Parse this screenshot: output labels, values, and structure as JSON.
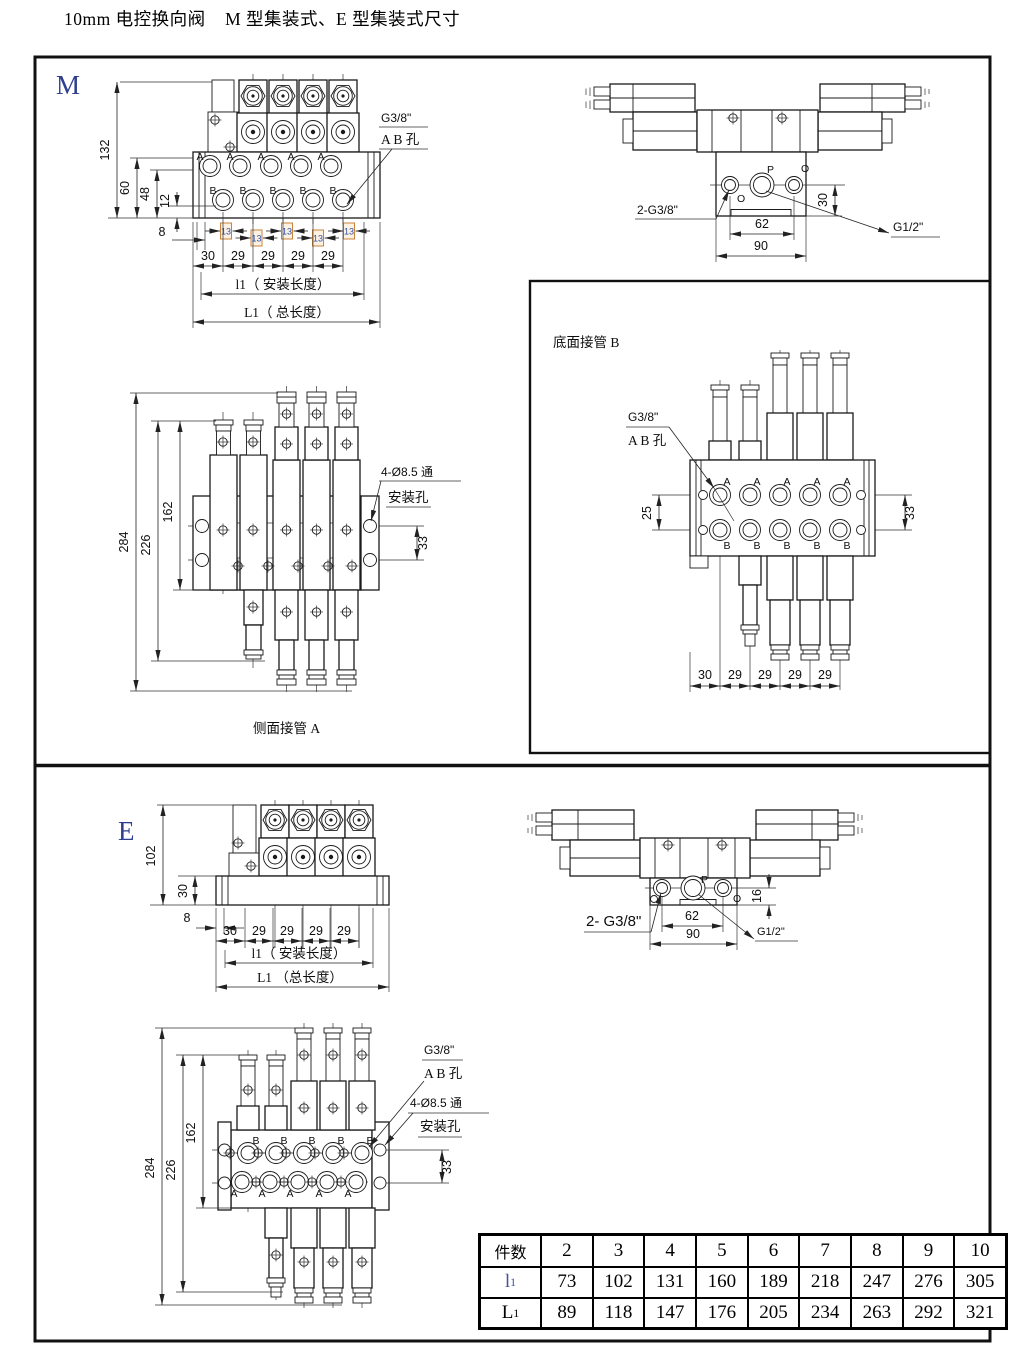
{
  "page": {
    "title": "10mm 电控换向阀    M 型集装式、E 型集装式尺寸"
  },
  "m": {
    "label": "M",
    "front": {
      "t132": "132",
      "t60": "60",
      "t48": "48",
      "t12": "12",
      "t8": "8",
      "pitch": [
        "30",
        "29",
        "29",
        "29",
        "29"
      ],
      "t13": [
        "13",
        "13",
        "13",
        "13",
        "13"
      ],
      "ports_a": [
        "A",
        "A",
        "A",
        "A",
        "A"
      ],
      "ports_b": [
        "B",
        "B",
        "B",
        "B",
        "B"
      ],
      "note1": "G3/8\"",
      "note2": "A B 孔",
      "lmount": "l1（ 安装长度）",
      "ltotal": "L1（ 总长度）"
    },
    "side": {
      "note": "2-G3/8\"",
      "g12": "G1/2\"",
      "t30": "30",
      "t62": "62",
      "t90": "90",
      "pp": "P",
      "po1": "O",
      "po2": "O"
    },
    "top": {
      "t284": "284",
      "t226": "226",
      "t162": "162",
      "t33": "33",
      "note1": "4-Ø8.5 通",
      "note2": "安装孔",
      "caption": "侧面接管 A"
    },
    "bottom": {
      "caption": "底面接管 B",
      "note1": "G3/8\"",
      "note2": "A B 孔",
      "t25": "25",
      "t33": "33",
      "pitch": [
        "30",
        "29",
        "29",
        "29",
        "29"
      ],
      "ports_a": [
        "A",
        "A",
        "A",
        "A",
        "A"
      ],
      "ports_b": [
        "B",
        "B",
        "B",
        "B",
        "B"
      ]
    }
  },
  "e": {
    "label": "E",
    "front": {
      "t102": "102",
      "t30": "30",
      "t8": "8",
      "pitch": [
        "30",
        "29",
        "29",
        "29",
        "29"
      ],
      "lmount": "l1（ 安装长度）",
      "ltotal": "L1 （总长度）"
    },
    "side": {
      "note": "2- G3/8\"",
      "g12": "G1/2\"",
      "t16": "16",
      "t62": "62",
      "t90": "90",
      "pp": "P",
      "po": "O"
    },
    "top": {
      "t284": "284",
      "t226": "226",
      "t162": "162",
      "t33": "33",
      "note1": "G3/8\"",
      "note2": "A B 孔",
      "note3": "4-Ø8.5 通",
      "note4": "安装孔",
      "ports_b": [
        "B",
        "B",
        "B",
        "B",
        "B"
      ],
      "ports_a": [
        "A",
        "A",
        "A",
        "A",
        "A"
      ]
    }
  },
  "table": {
    "rows": [
      {
        "h": "件数",
        "v": [
          "2",
          "3",
          "4",
          "5",
          "6",
          "7",
          "8",
          "9",
          "10"
        ]
      },
      {
        "hm": "l",
        "hs": "1",
        "v": [
          "73",
          "102",
          "131",
          "160",
          "189",
          "218",
          "247",
          "276",
          "305"
        ]
      },
      {
        "hm": "L",
        "hs": "1",
        "v": [
          "89",
          "118",
          "147",
          "176",
          "205",
          "234",
          "263",
          "292",
          "321"
        ]
      }
    ]
  }
}
